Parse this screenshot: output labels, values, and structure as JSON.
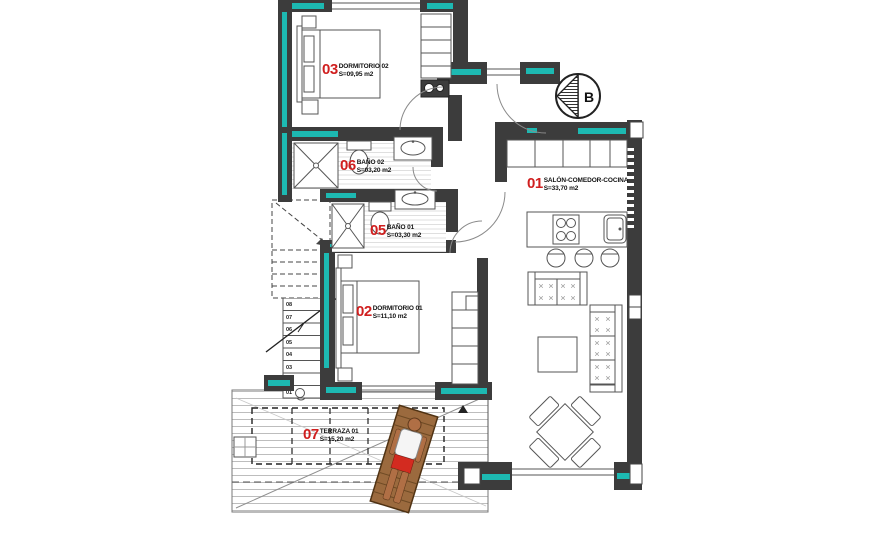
{
  "plan": {
    "rooms": [
      {
        "number": "03",
        "name": "DORMITORIO 02",
        "area": "S=09,95 m2"
      },
      {
        "number": "06",
        "name": "BAÑO 02",
        "area": "S=03,20 m2"
      },
      {
        "number": "05",
        "name": "BAÑO 01",
        "area": "S=03,30 m2"
      },
      {
        "number": "02",
        "name": "DORMITORIO 01",
        "area": "S=11,10 m2"
      },
      {
        "number": "01",
        "name": "SALÓN-COMEDOR-COCINA",
        "area": "S=33,70 m2"
      },
      {
        "number": "07",
        "name": "TERRAZA 01",
        "area": "S=15,20 m2"
      }
    ],
    "compass": {
      "label": "B"
    },
    "stairs": {
      "steps": [
        "08",
        "07",
        "06",
        "05",
        "04",
        "03",
        "02",
        "01"
      ]
    },
    "colors": {
      "wall": "#3c3c3c",
      "accent": "#1db9b2",
      "room_number": "#d01f1f",
      "text": "#111111"
    }
  }
}
